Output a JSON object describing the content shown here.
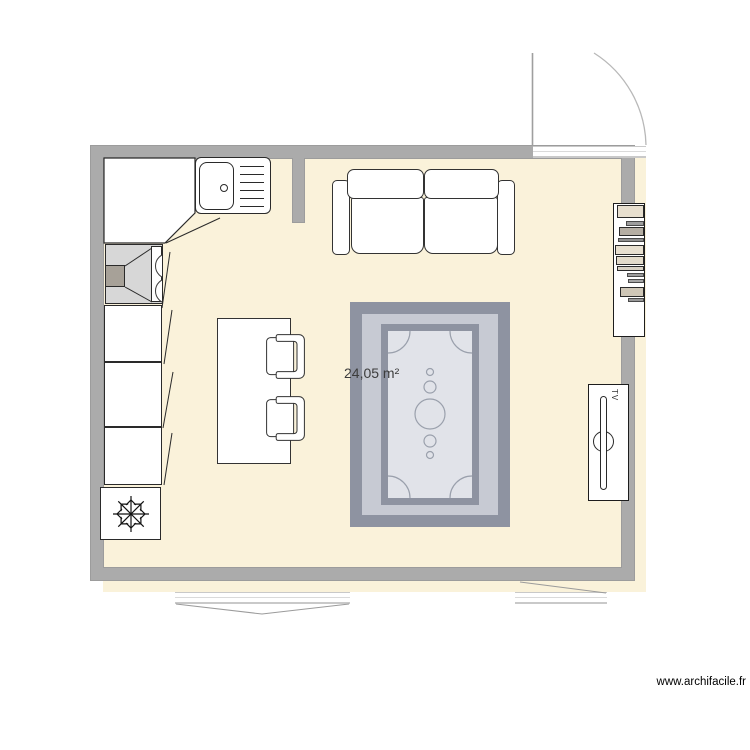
{
  "plan": {
    "room": {
      "area_label": "24,05 m²",
      "floor_color": "#faf2da",
      "wall_color": "#ababab"
    },
    "tv": {
      "label": "TV"
    },
    "rug": {
      "border_color": "#8e93a1",
      "band_color": "#c7cad3",
      "inner_color": "#e1e3e9"
    },
    "bookshelf": {
      "books": [
        {
          "top": 1,
          "width": 27,
          "height": 13,
          "color": "#e7dfcf",
          "border": "#2a2a2a"
        },
        {
          "top": 17,
          "width": 18,
          "height": 5,
          "color": "#9d9d9d",
          "border": "#4a4a4a"
        },
        {
          "top": 23,
          "width": 25,
          "height": 9,
          "color": "#b5aea3",
          "border": "#2a2a2a"
        },
        {
          "top": 34,
          "width": 26,
          "height": 4,
          "color": "#8e8e8e",
          "border": "#4a4a4a"
        },
        {
          "top": 41,
          "width": 29,
          "height": 10,
          "color": "#e7dfcf",
          "border": "#2a2a2a"
        },
        {
          "top": 52,
          "width": 28,
          "height": 9,
          "color": "#e3dbca",
          "border": "#2a2a2a"
        },
        {
          "top": 62,
          "width": 27,
          "height": 5,
          "color": "#d8d1c3",
          "border": "#2a2a2a"
        },
        {
          "top": 69,
          "width": 17,
          "height": 4,
          "color": "#9b9b9b",
          "border": "#4a4a4a"
        },
        {
          "top": 75,
          "width": 16,
          "height": 4,
          "color": "#a5a5a5",
          "border": "#4a4a4a"
        },
        {
          "top": 83,
          "width": 24,
          "height": 10,
          "color": "#cfc7b7",
          "border": "#2a2a2a"
        },
        {
          "top": 94,
          "width": 16,
          "height": 4,
          "color": "#989898",
          "border": "#4a4a4a"
        }
      ]
    },
    "watermark": "www.archifacile.fr"
  }
}
